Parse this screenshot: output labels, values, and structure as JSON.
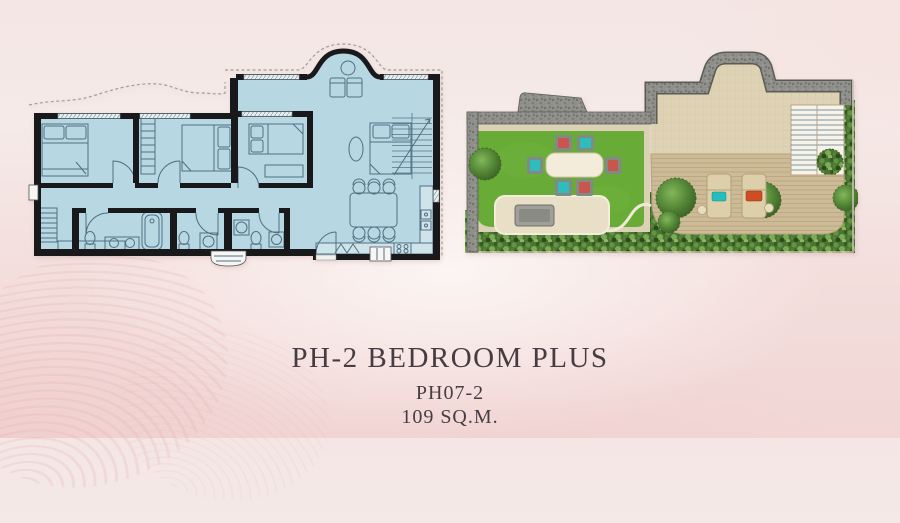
{
  "caption": {
    "title": "PH-2 BEDROOM PLUS",
    "unit": "PH07-2",
    "area": "109 SQ.M."
  },
  "colors": {
    "text": "#463d43",
    "floor": "#b7d7e3",
    "walls": "#19191b",
    "lawn": "#68ab36",
    "terrace_wall": "#8f8f8c",
    "paving": "#dbd1b4",
    "deck": "#cdbb97",
    "shrubs": "#4a7431",
    "chair_red": "#c9564d",
    "chair_teal": "#2fbcba",
    "lounger_pillow_teal": "#27bdbd",
    "lounger_pillow_red": "#cf4d24"
  }
}
